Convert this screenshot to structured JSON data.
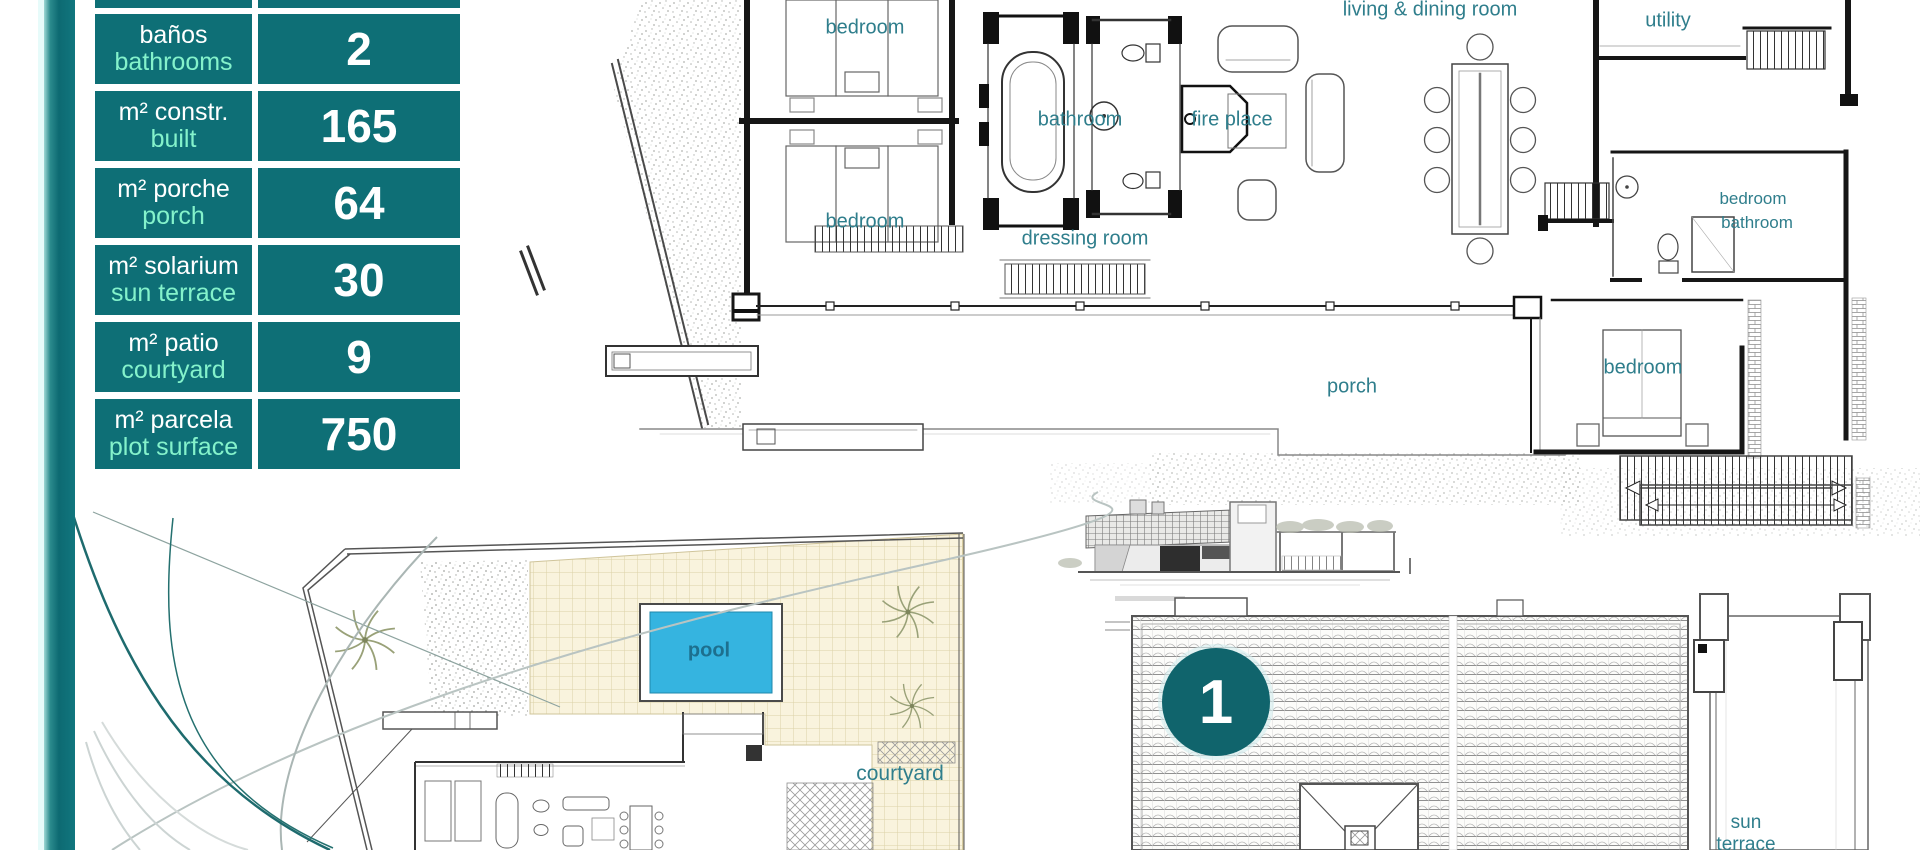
{
  "colors": {
    "teal_table": "#0e6f76",
    "teal_bar_dark": "#0d6a72",
    "teal_badge": "#10646c",
    "mint_text": "#84f2cb",
    "plan_label_text": "#2f7e8c",
    "pool_water": "#35b4e0"
  },
  "spec_table": {
    "rows": [
      {
        "es": "baños",
        "en": "bathrooms",
        "value": "2"
      },
      {
        "es": "m² constr.",
        "en": "built",
        "value": "165"
      },
      {
        "es": "m² porche",
        "en": "porch",
        "value": "64"
      },
      {
        "es": "m² solarium",
        "en": "sun terrace",
        "value": "30"
      },
      {
        "es": "m² patio",
        "en": "courtyard",
        "value": "9"
      },
      {
        "es": "m² parcela",
        "en": "plot surface",
        "value": "750"
      }
    ]
  },
  "unit_badge": {
    "number": "1"
  },
  "plan_labels": {
    "ground": [
      "bedroom",
      "bathroom",
      "fire place",
      "living & dining room",
      "utility",
      "bedroom",
      "dressing room",
      "bedroom",
      "bathroom",
      "porch",
      "bedroom"
    ],
    "site": [
      "pool",
      "courtyard"
    ],
    "roof": [
      "sun terrace"
    ]
  }
}
